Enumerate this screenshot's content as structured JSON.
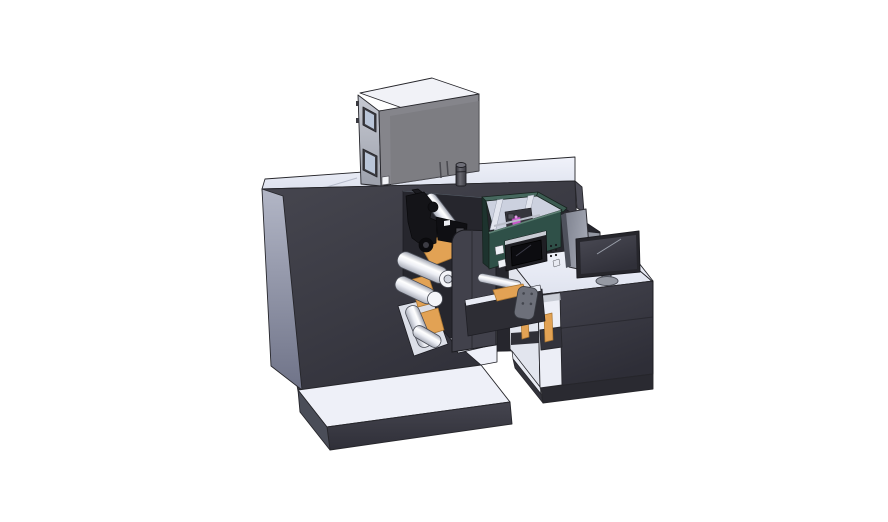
{
  "scene": {
    "type": "3d-cad-render",
    "subject": "label printing press line: unwinder cabinet with web rollers, dryer box on top, inkjet print unit, transfer bridge and operator control desk with monitor",
    "background": "#ffffff"
  },
  "palette": {
    "outline": "#26262b",
    "machine_body_dark": "#3a3a44",
    "machine_top_light": "#e9ecf6",
    "machine_side_gray": "#8f93a8",
    "niche_shadow": "#26262d",
    "plate_orange": "#e2a254",
    "roller_white": "#f4f5f9",
    "print_unit_teal": "#2f5048",
    "interior_light": "#ccd1df",
    "magenta_cartridge": "#c65bc9",
    "dryer_box_gray": "#85858b",
    "window_glass": "#b9c5d8",
    "desk_body_dark": "#3d3d47",
    "display_black": "#0c0c10",
    "bracket_gray": "#6d707a",
    "monitor_frame": "#26262c",
    "platform_top": "#eef0f8"
  },
  "parts": [
    "main-cabinet",
    "base-platform",
    "dryer-box",
    "web-rollers",
    "orange-guide-plates",
    "print-head-mechanism",
    "inkjet-unit",
    "unit-display",
    "transfer-bridge",
    "control-desk",
    "desk-shelf",
    "monitor",
    "rear-monitor-panel",
    "exhaust-cylinder"
  ]
}
